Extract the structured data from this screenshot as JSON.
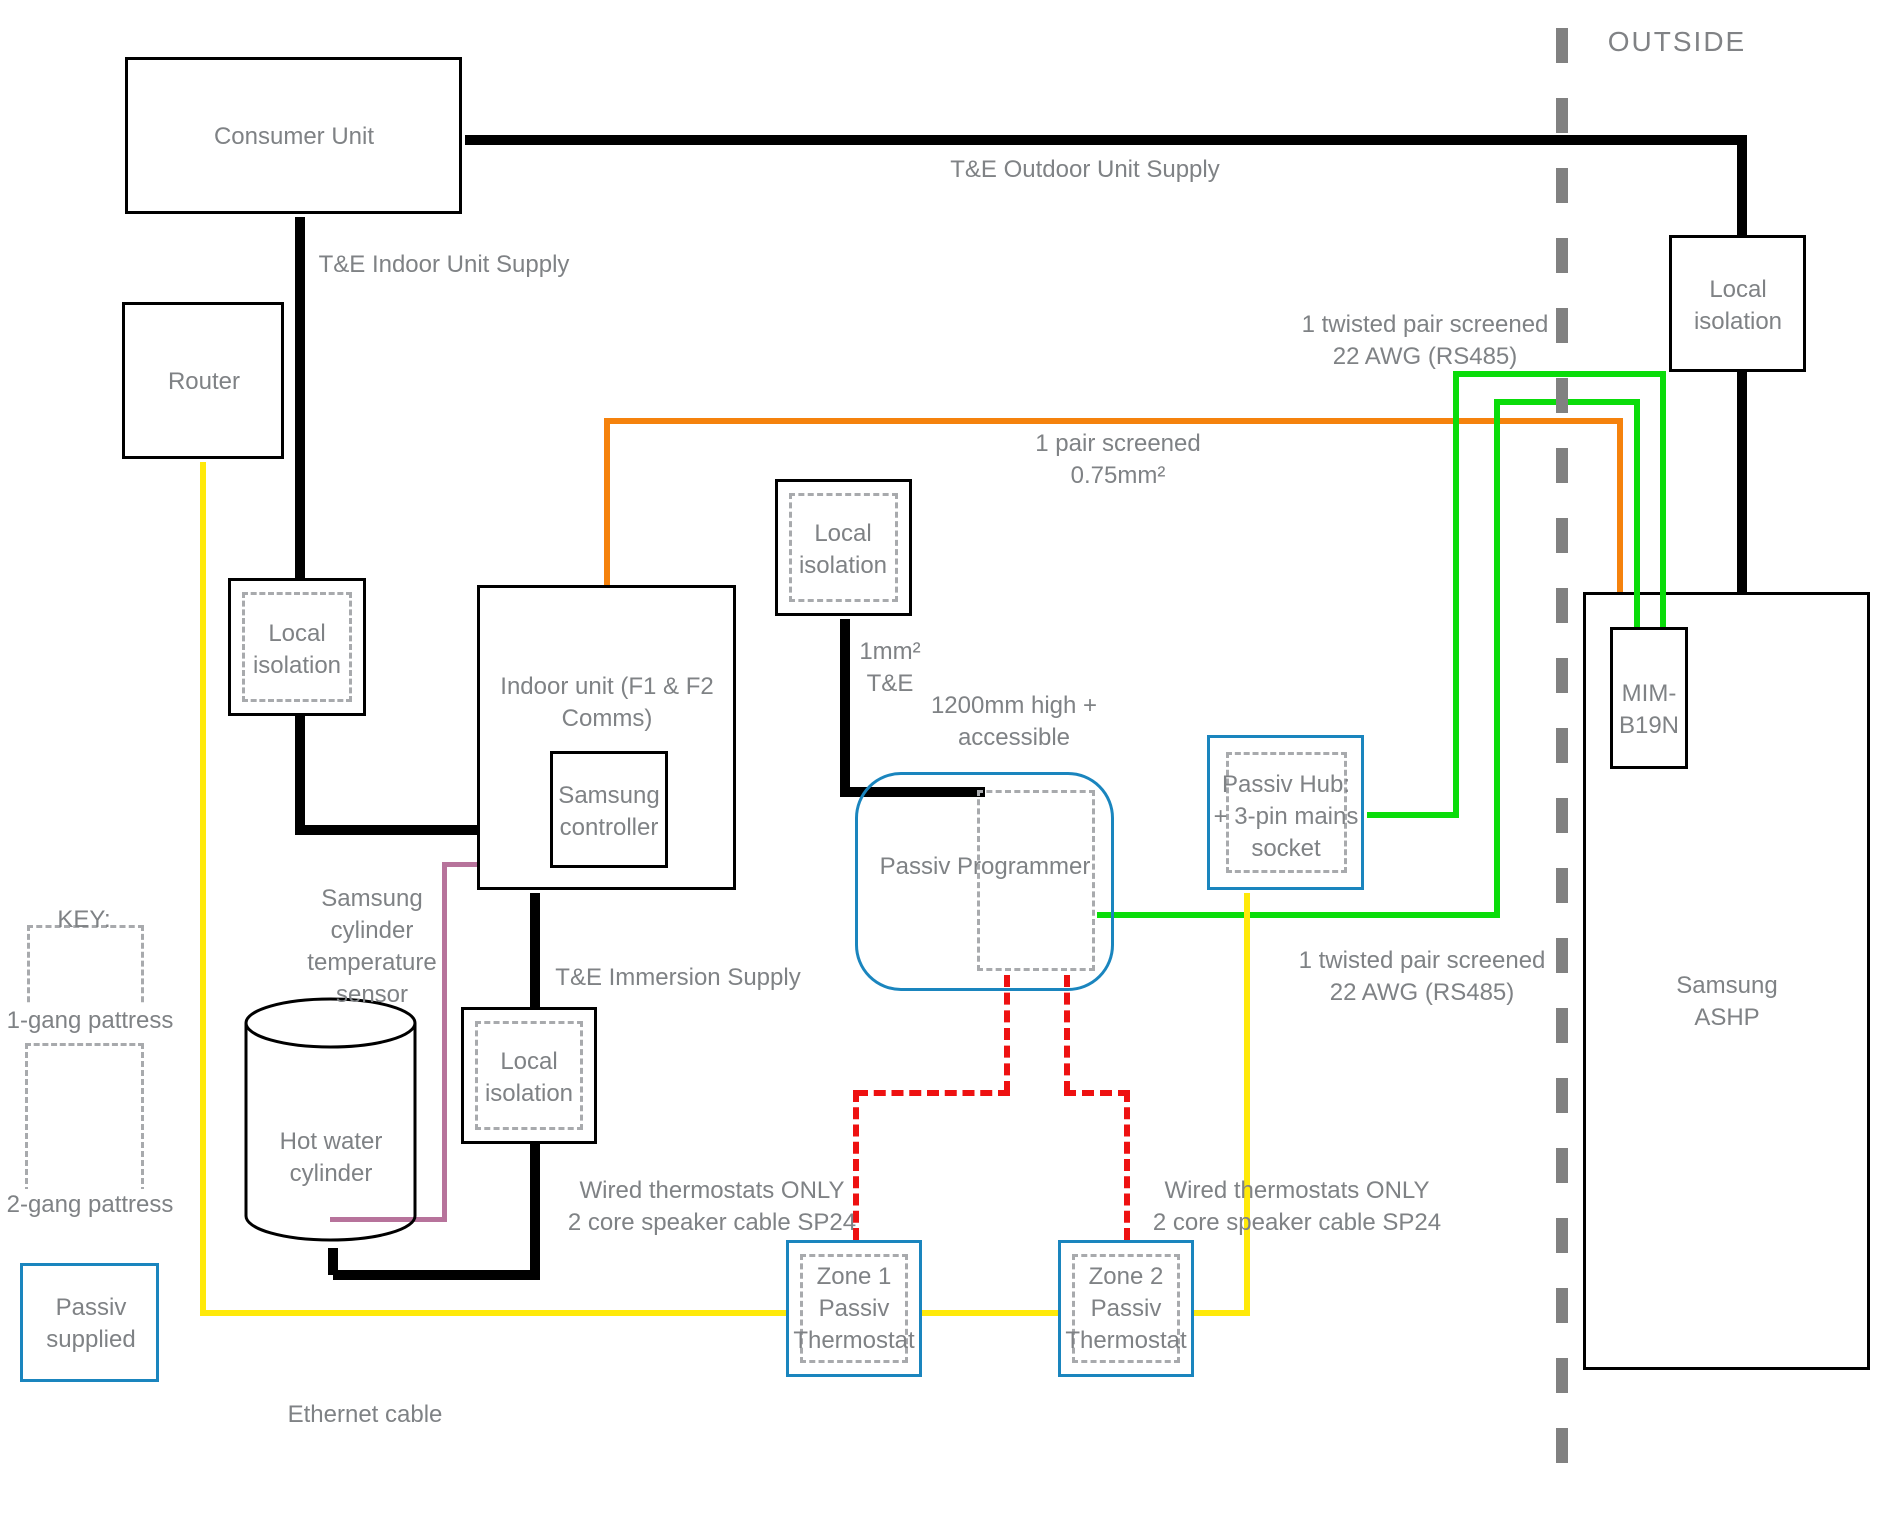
{
  "outside": {
    "label": "OUTSIDE"
  },
  "boxes": {
    "consumer_unit": "Consumer Unit",
    "router": "Router",
    "local_isolation": "Local\nisolation",
    "indoor_unit": "Indoor unit (F1 & F2\nComms)",
    "samsung_controller": "Samsung\ncontroller",
    "passiv_programmer": "Passiv Programmer",
    "passiv_hub": "Passiv Hub:\n+ 3-pin mains\nsocket",
    "mim_b19n": "MIM-\nB19N",
    "samsung_ashp": "Samsung ASHP",
    "zone1_thermostat": "Zone 1\nPassiv\nThermostat",
    "zone2_thermostat": "Zone 2\nPassiv\nThermostat",
    "hot_water_cylinder": "Hot water\ncylinder"
  },
  "wire_labels": {
    "te_outdoor": "T&E Outdoor Unit Supply",
    "te_indoor": "T&E Indoor Unit Supply",
    "rs485_top": "1 twisted pair screened\n22 AWG (RS485)",
    "rs485_bottom": "1 twisted pair screened\n22 AWG (RS485)",
    "pair_screened": "1 pair screened\n0.75mm²",
    "mm2_te": "1mm²\nT&E",
    "high_1200": "1200mm high +\naccessible",
    "te_immersion": "T&E Immersion Supply",
    "cylinder_sensor": "Samsung\ncylinder\ntemperature\nsensor",
    "wired_left": "Wired thermostats ONLY\n2 core speaker cable SP24",
    "wired_right": "Wired thermostats ONLY\n2 core speaker cable SP24",
    "ethernet": "Ethernet cable"
  },
  "key": {
    "title": "KEY:",
    "gang1": "1-gang pattress",
    "gang2": "2-gang pattress",
    "passiv_supplied": "Passiv\nsupplied"
  },
  "colors": {
    "mains_cable": "#000000",
    "sensor_pair_cable": "#F5820D",
    "rs485_cable": "#0ADC0A",
    "ethernet_cable": "#FFE90A",
    "cylinder_sensor_cable": "#B7739B",
    "thermostat_cable": "#EE1111",
    "passiv_box_border": "#1A85BE",
    "diagram_text": "#7F8285"
  }
}
